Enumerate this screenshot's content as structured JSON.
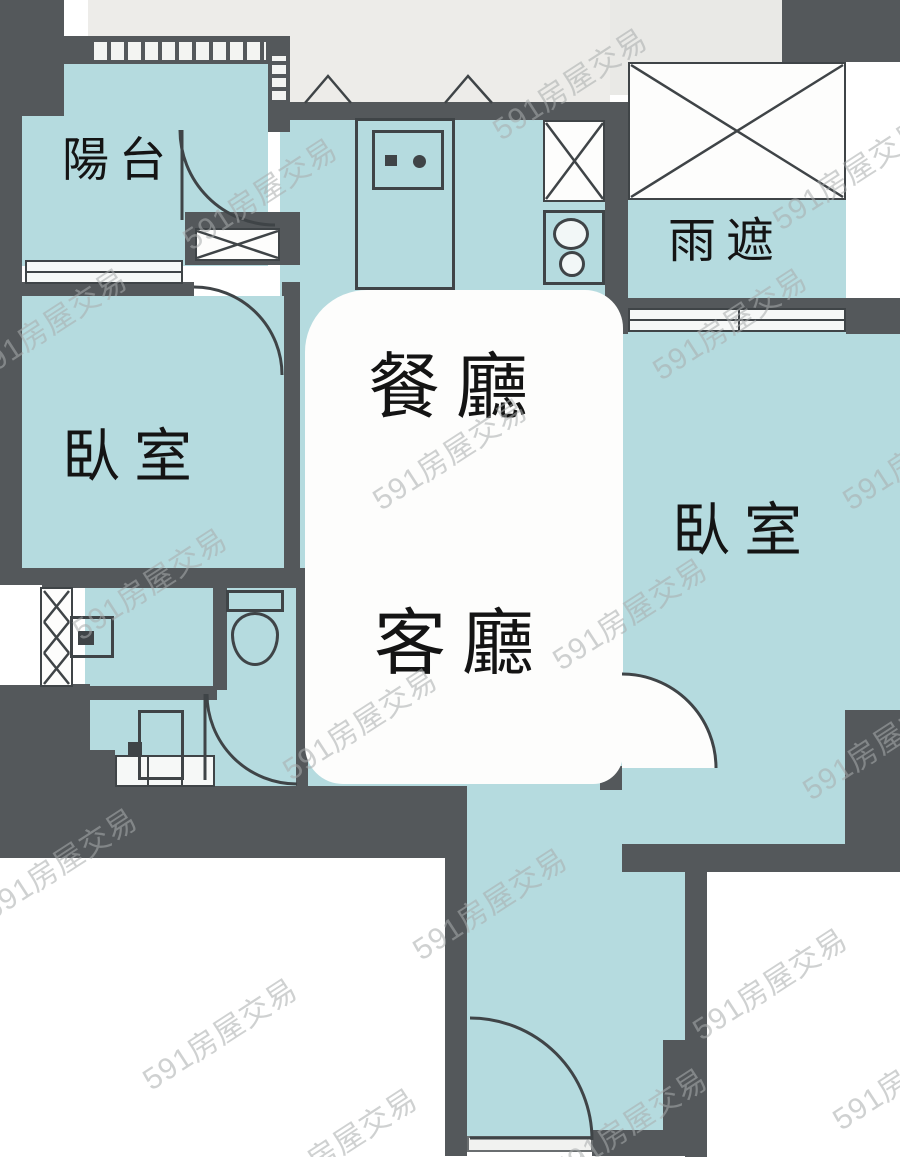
{
  "title": "apartment-floor-plan",
  "colors": {
    "room_fill": "#b5dbdf",
    "wall": "#54585b",
    "thin_line": "#3f4447",
    "light_gray": "#edece9",
    "outside": "#ffffff",
    "callout_fill": "#fdfdfc",
    "watermark": "#a9adad",
    "label_text": "#141414"
  },
  "rooms": {
    "balcony": {
      "label": "陽台"
    },
    "rain_cover": {
      "label": "雨遮"
    },
    "bedroom_left": {
      "label": "臥室"
    },
    "bedroom_right": {
      "label": "臥室"
    },
    "dining_room": {
      "label": "餐廳"
    },
    "living_room": {
      "label": "客廳"
    }
  },
  "watermark": {
    "text": "591房屋交易"
  }
}
